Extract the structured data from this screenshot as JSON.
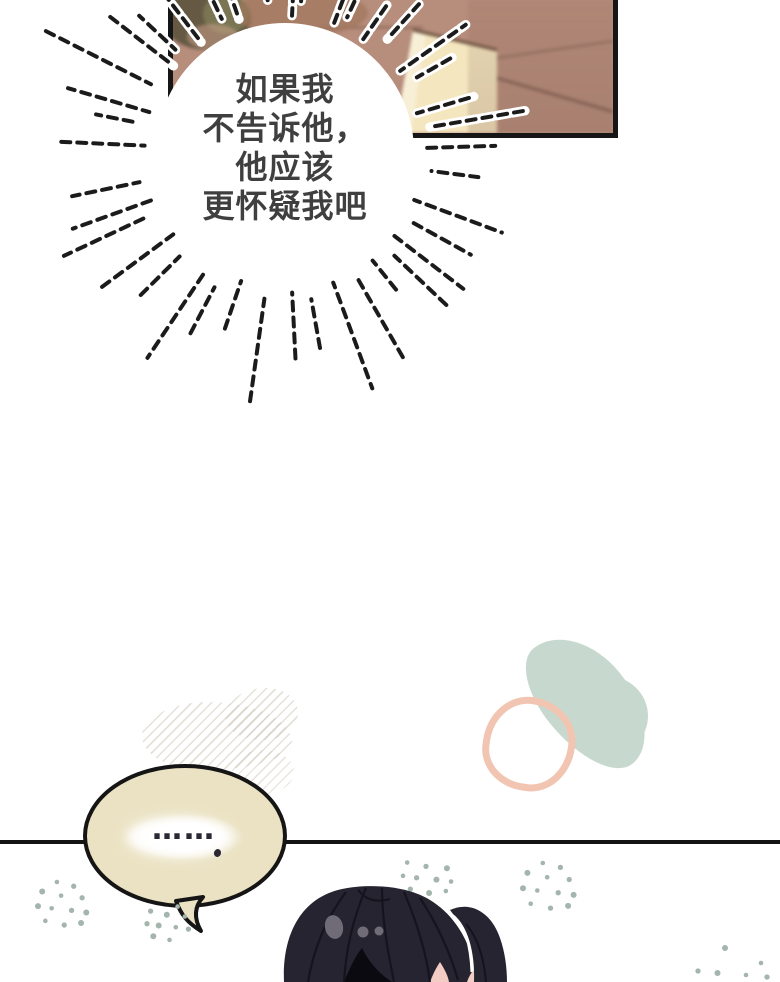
{
  "page": {
    "bg": "#ffffff"
  },
  "panel": {
    "bg": "#b78d7c",
    "border_color": "#161616",
    "drawer_fill": "#f4e6bf",
    "drawer_edge": "#6d5340",
    "shadow_line": "#8b675a",
    "shelf_dark": "#5e553f",
    "shelf_green": "#7f7d58",
    "shelf_pink": "#c9a089"
  },
  "thought": {
    "lines": [
      "如果我",
      "不告诉他，",
      "他应该",
      "更怀疑我吧"
    ],
    "text_color": "#3f3f3f",
    "ray_color": "#1b1b1b",
    "fill": "#ffffff"
  },
  "speech": {
    "text": "……",
    "fill": "#ebe2c3",
    "stroke": "#151515",
    "dot_color": "#2a2833"
  },
  "decor": {
    "hatch": "#cfc8ba",
    "green": "#c7d9ce",
    "ring": "#f1c5b2",
    "stipple": "#a3b5ad",
    "divider": "#141414"
  },
  "character": {
    "hair": "#262430",
    "hair_line": "#14121c",
    "highlight": "#6f6c78",
    "skin": "#f3cdc4",
    "gap": "#0b0a10"
  }
}
